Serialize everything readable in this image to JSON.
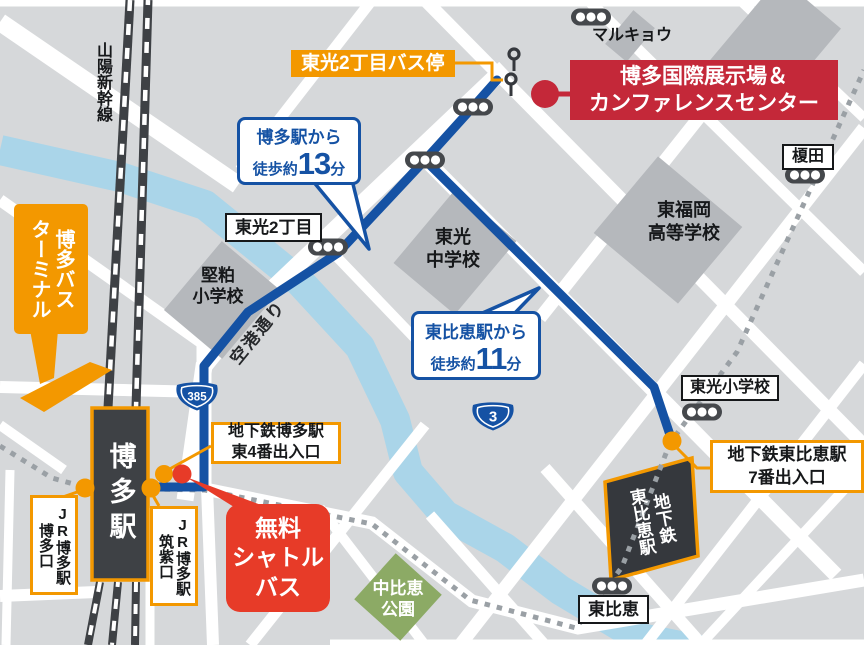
{
  "colors": {
    "route_blue": "#1552a4",
    "orange": "#f39800",
    "banner_red": "#c42839",
    "shuttle_red": "#e73b28",
    "park_green": "#8caa65",
    "river_blue": "#aad5e9",
    "building_gray": "#b5b8bc",
    "dark_gray": "#3e4145",
    "background": "#d6d8da"
  },
  "destination": {
    "banner": [
      "博多国際展示場＆",
      "カンファレンスセンター"
    ]
  },
  "callouts": {
    "from_hakata": {
      "from": "博多駅から",
      "walk": "徒歩約",
      "minutes": "13",
      "unit": "分"
    },
    "from_higashihie": {
      "from": "東比恵駅から",
      "walk": "徒歩約",
      "minutes": "11",
      "unit": "分"
    },
    "shuttle": [
      "無料",
      "シャトル",
      "バス"
    ]
  },
  "roads": {
    "route385": "385",
    "route3": "3",
    "kuko_dori": "空港通り"
  },
  "stations": {
    "hakata": "博多駅",
    "jr_hakata_exit": [
      "JR博多駅",
      "博多口"
    ],
    "jr_chikushi_exit": [
      "JR博多駅",
      "筑紫口"
    ],
    "subway_hakata_exit": [
      "地下鉄博多駅",
      "東4番出入口"
    ],
    "subway_higashihie": [
      "地下鉄",
      "東比恵駅"
    ],
    "subway_higashihie_exit": [
      "地下鉄東比恵駅",
      "7番出入口"
    ],
    "bus_terminal": [
      "博多バス",
      "ターミナル"
    ],
    "bus_stop": "東光2丁目バス停",
    "shinkansen": "山陽新幹線"
  },
  "places": {
    "marukyou": "マルキョウ",
    "enokida": "榎田",
    "toko_2chome": "東光2丁目",
    "katakasu_es": [
      "堅粕",
      "小学校"
    ],
    "toko_jhs": [
      "東光",
      "中学校"
    ],
    "higashi_fukuoka_hs": [
      "東福岡",
      "高等学校"
    ],
    "toko_es": "東光小学校",
    "nakahie_park": [
      "中比恵",
      "公園"
    ],
    "higashihie": "東比恵"
  }
}
